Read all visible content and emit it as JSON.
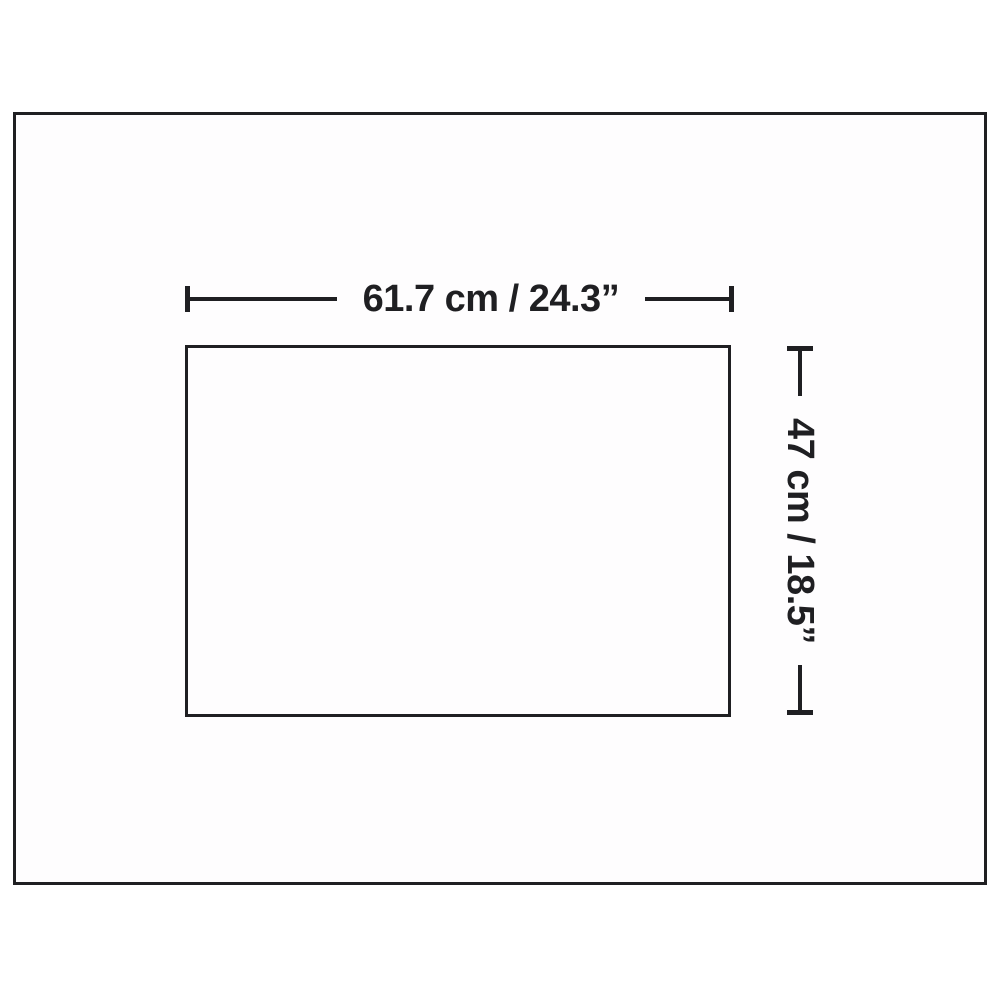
{
  "diagram": {
    "width_dimension": {
      "label": "61.7 cm / 24.3”"
    },
    "height_dimension": {
      "label": "47 cm / 18.5”"
    },
    "colors": {
      "line": "#1f1f22",
      "background": "#ffffff"
    }
  }
}
